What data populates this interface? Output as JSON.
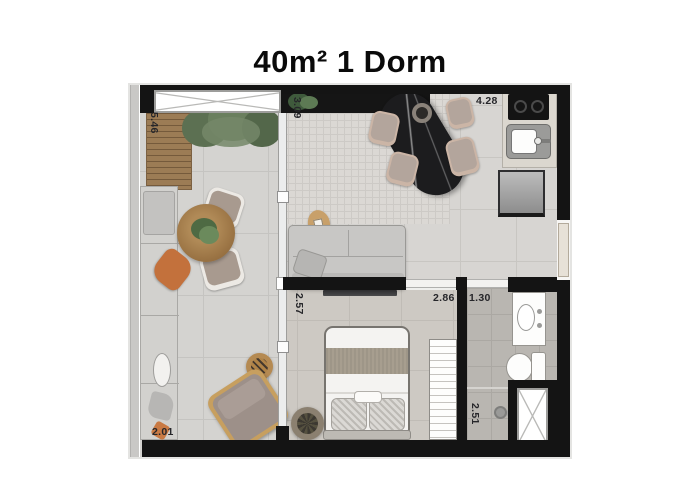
{
  "title": "40m² 1 Dorm",
  "dimensions": {
    "balcony_length": "5.46",
    "living_depth": "3.09",
    "kitchen_width": "4.28",
    "bedroom_depth": "2.57",
    "bedroom_width": "2.86",
    "bathroom_width": "1.30",
    "balcony_width": "2.01",
    "bathroom_depth": "2.51"
  },
  "colors": {
    "wall": "#141414",
    "floor_light": "#d7d5d2",
    "deck_wood": "#9c7c55",
    "accent_orange": "#c3713c",
    "marble_table": "#1c1c1e",
    "greenery": "#5c7052"
  }
}
